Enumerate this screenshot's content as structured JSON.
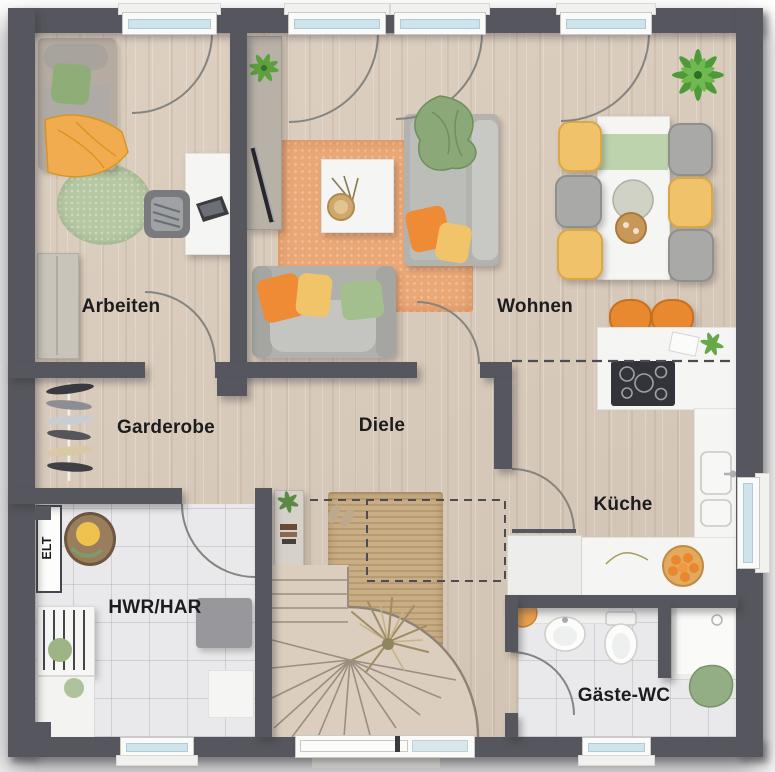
{
  "palette": {
    "wall": "#56565e",
    "wood_floor": "#d7cabb",
    "tile_floor": "#e9e9eb",
    "rug_orange": "#eba877",
    "rug_green": "#b6c8a3",
    "rug_jute": "#c9ad85",
    "accent_orange": "#ef8a35",
    "accent_yellow": "#f2c469",
    "accent_green": "#8fae77",
    "window_glass": "#cfe3ed"
  },
  "rooms": {
    "arbeiten": {
      "label": "Arbeiten"
    },
    "wohnen": {
      "label": "Wohnen"
    },
    "garderobe": {
      "label": "Garderobe"
    },
    "diele": {
      "label": "Diele"
    },
    "kueche": {
      "label": "Küche"
    },
    "hwr": {
      "label": "HWR/HAR"
    },
    "gaeste_wc": {
      "label": "Gäste-WC"
    },
    "elt": {
      "label": "ELT"
    }
  }
}
